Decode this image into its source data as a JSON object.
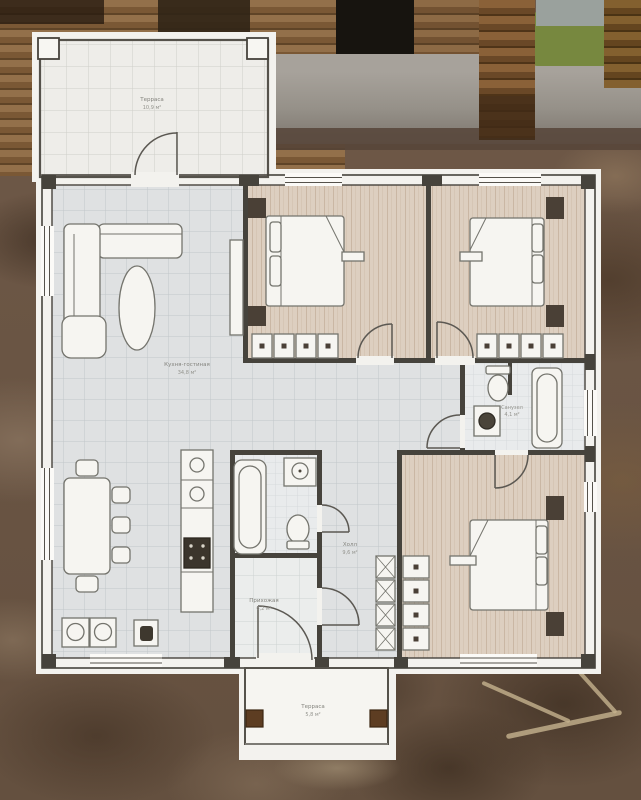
{
  "plan": {
    "labels": {
      "terrace_top": {
        "name": "Терраса",
        "area": "10,9 м²"
      },
      "kitchen_living": {
        "name": "Кухня-гостиная",
        "area": "34,8 м²"
      },
      "hall": {
        "name": "Холл",
        "area": "9,6 м²"
      },
      "entry": {
        "name": "Прихожая",
        "area": "6,2 м²"
      },
      "bathroom": {
        "name": "Санузел",
        "area": "4,1 м²"
      },
      "terrace_bottom": {
        "name": "Терраса",
        "area": "5,8 м²"
      }
    },
    "colors": {
      "paper": "#f3f2ee",
      "wall": "#46433c",
      "tile_floor": "#dfe1e2",
      "wood_floor": "#ddcfc0",
      "bath_floor": "#e9ebec",
      "dark_furniture": "#4a4036",
      "porch_post": "#5d3d22"
    }
  }
}
